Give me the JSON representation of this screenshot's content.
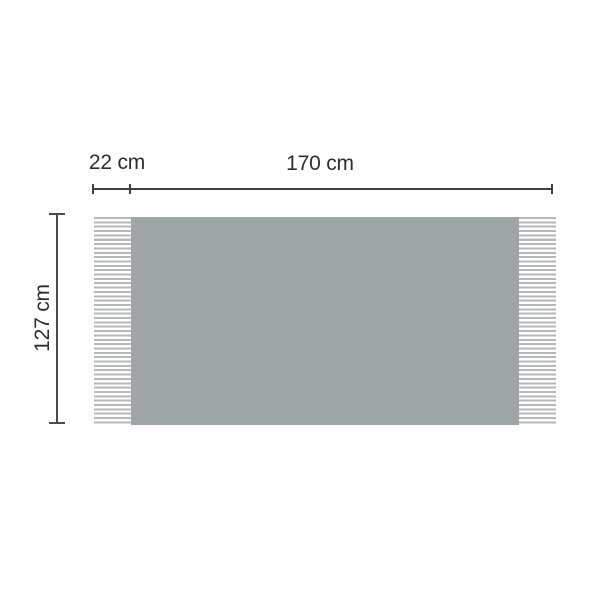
{
  "diagram": {
    "title": "Blanket with fringes dimension diagram",
    "product": "fringed-blanket",
    "labels": {
      "fringe_width": "22 cm",
      "width": "170 cm",
      "height": "127 cm"
    },
    "colors": {
      "blanket_fill": "#9fa4a7",
      "fringe_stripe": "#b4b8ba",
      "dimension_line": "#3f4143",
      "label_text": "#2e2e2e",
      "background": "#ffffff"
    }
  }
}
